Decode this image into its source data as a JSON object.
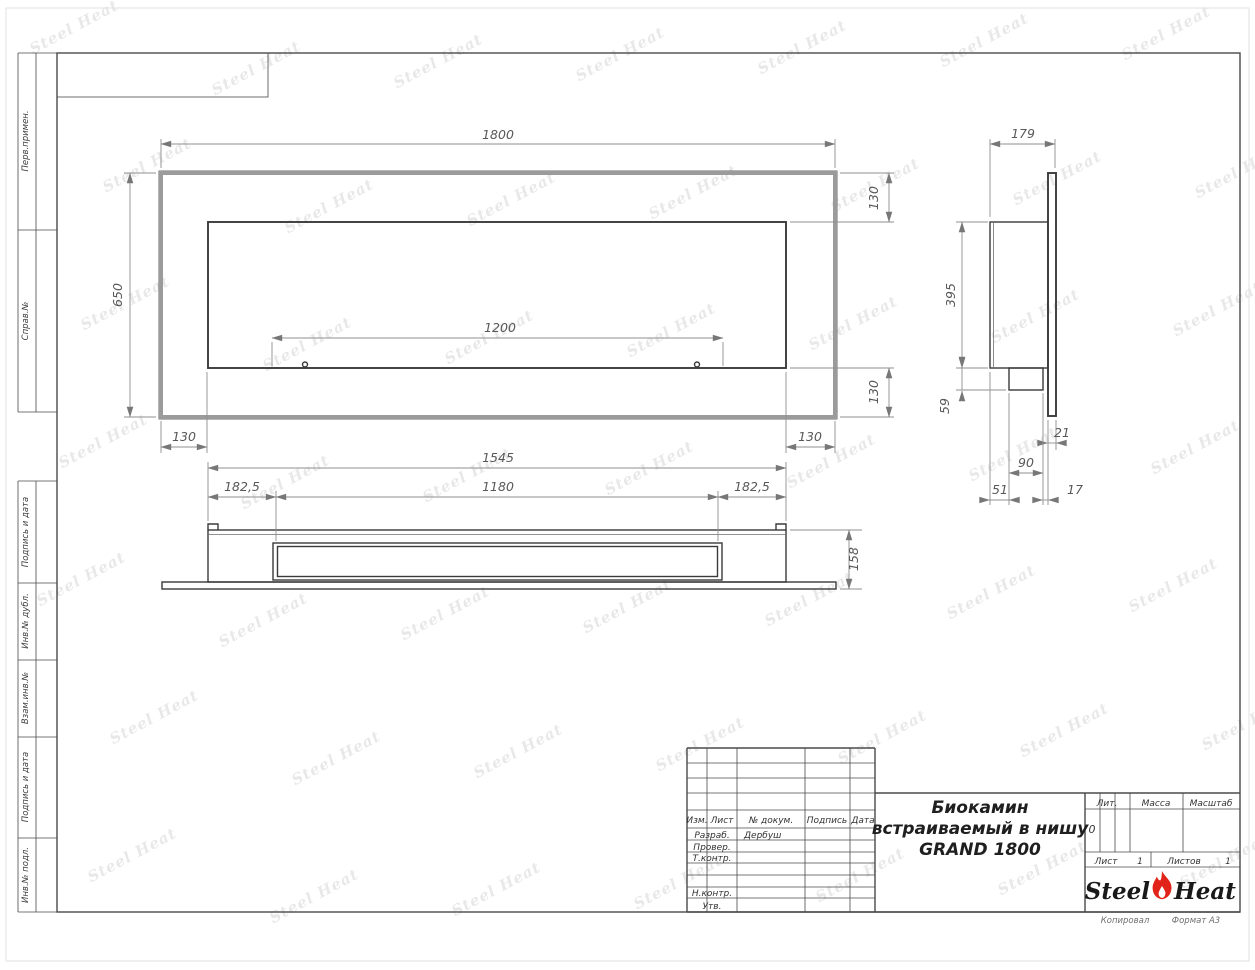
{
  "watermark": {
    "text": "Steel Heat"
  },
  "colors": {
    "flame_red": "#e2231a",
    "line_dark": "#3a3a3a",
    "line_grey": "#9b9b9b",
    "dim_grey": "#8f8f8f"
  },
  "margin": {
    "perv_primen": "Перв.примен.",
    "sprav_no": "Справ.№",
    "podpis_i_data_1": "Подпись и дата",
    "inv_no_dubl": "Инв.№ дубл.",
    "vzam_inv_no": "Взам.инв.№",
    "podpis_i_data_2": "Подпись и дата",
    "inv_no_podl": "Инв.№ подл."
  },
  "dimensions": {
    "front_width": "1800",
    "front_height": "650",
    "right_top_border": "130",
    "right_bottom_border": "130",
    "bottom_left_border": "130",
    "bottom_right_border": "130",
    "burner_length": "1200",
    "plan_width": "1545",
    "plan_inset_left": "182,5",
    "plan_slot_width": "1180",
    "plan_inset_right": "182,5",
    "plan_depth": "158",
    "side_depth": "179",
    "side_inner_height": "395",
    "side_tray_height": "59",
    "side_flange": "21",
    "side_tray_depth": "90",
    "side_back_offset": "51",
    "side_gap": "17"
  },
  "title_block": {
    "header": {
      "izm": "Изм.",
      "list": "Лист",
      "n_dokum": "№ докум.",
      "podpis": "Подпись",
      "data": "Дата"
    },
    "rows": {
      "razrab_label": "Разраб.",
      "razrab_value": "Дербуш",
      "prover_label": "Провер.",
      "tkontr_label": "Т.контр.",
      "nkontr_label": "Н.контр.",
      "utv_label": "Утв."
    },
    "title_line1": "Биокамин",
    "title_line2": "встраиваемый в нишу",
    "title_line3": "GRAND 1800",
    "lit_label": "Лит.",
    "lit_value": "0",
    "massa_label": "Масса",
    "masshtab_label": "Масштаб",
    "list_label": "Лист",
    "list_value": "1",
    "listov_label": "Листов",
    "listov_value": "1",
    "brand_left": "Steel",
    "brand_right": "Heat",
    "kopiroval": "Копировал",
    "format": "Формат А3"
  }
}
